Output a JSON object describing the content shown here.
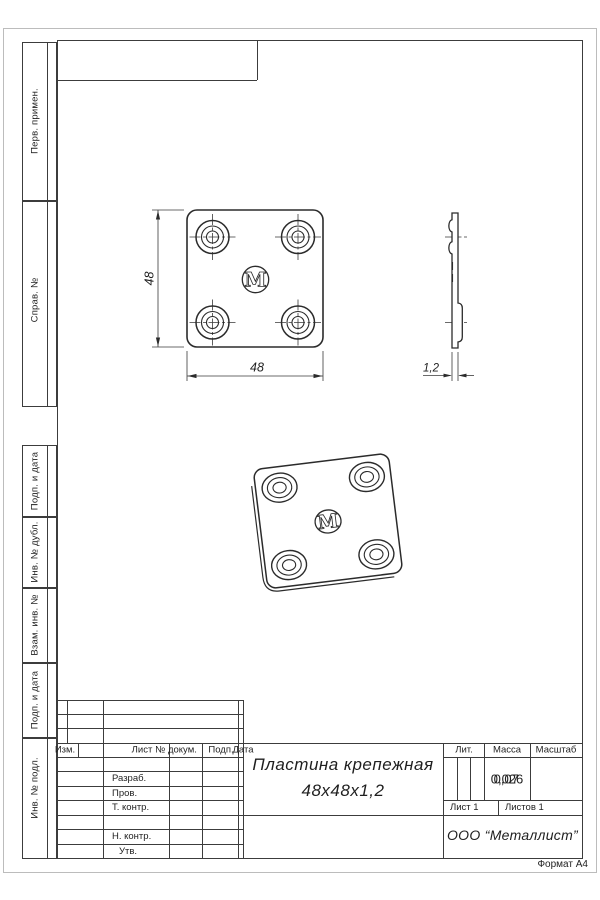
{
  "page": {
    "format_label": "Формат А4"
  },
  "margin_boxes": {
    "perv_primen": "Перв. примен.",
    "sprav_no": "Справ. №",
    "podp_data_1": "Подп. и дата",
    "inv_dubl": "Инв. № дубл.",
    "vzam_inv": "Взам. инв. №",
    "podp_data_2": "Подп. и дата",
    "inv_podl": "Инв. № подл."
  },
  "views": {
    "dim_height": "48",
    "dim_width": "48",
    "dim_thickness": "1,2",
    "logo_letter": "M"
  },
  "title_block": {
    "col_izm": "Изм.",
    "col_list": "Лист",
    "col_dokum": "№ докум.",
    "col_podp": "Подп.",
    "col_data": "Дата",
    "row_razrab": "Разраб.",
    "row_prov": "Пров.",
    "row_tkontr": "Т. контр.",
    "row_nkontr": "Н. контр.",
    "row_utv": "Утв.",
    "name_line1": "Пластина крепежная",
    "name_line2": "48х48х1,2",
    "lit_label": "Лит.",
    "massa_label": "Масса",
    "masshtab_label": "Масштаб",
    "massa_value_a": "0,026",
    "massa_value_b": "0,07",
    "list_label": "Лист 1",
    "listov_label": "Листов 1",
    "company": "ООО “Металлист”"
  }
}
